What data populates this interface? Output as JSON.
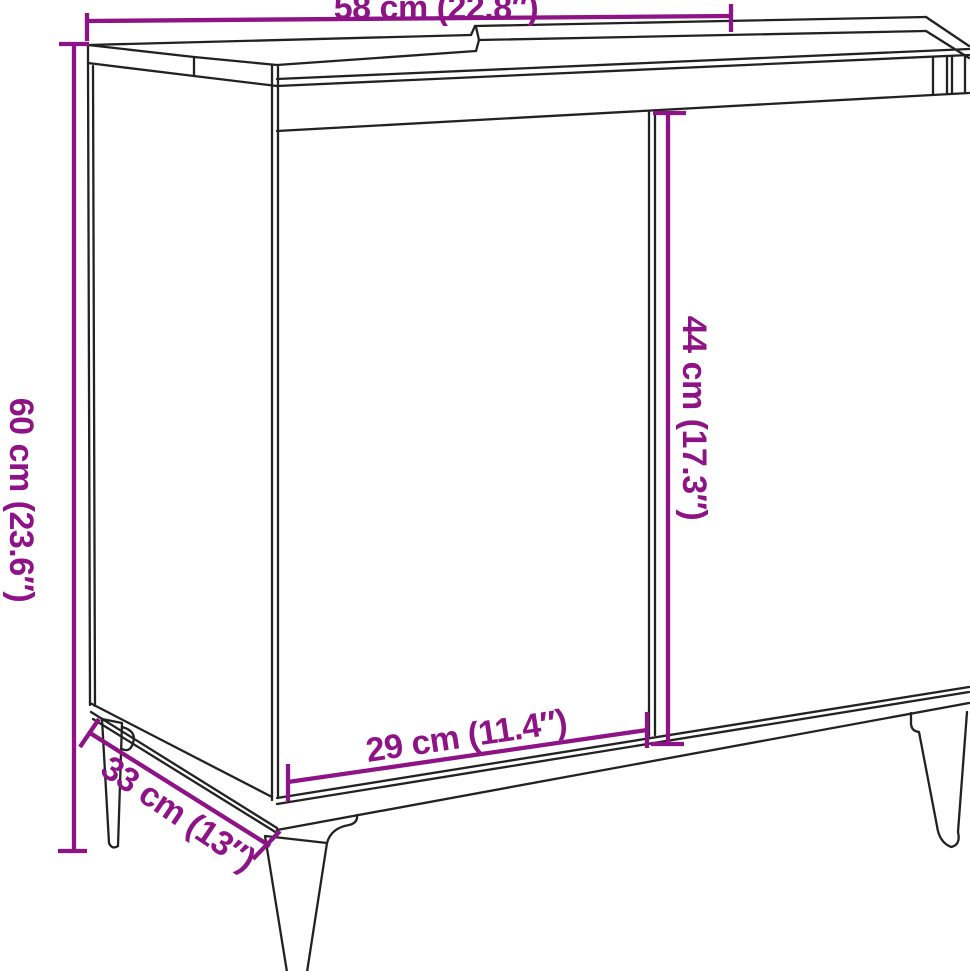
{
  "diagram": {
    "background_color": "#ffffff",
    "accent_color": "#8E1386",
    "line_color": "#222222",
    "dimensions": {
      "top_width": "58 cm (22.8″)",
      "total_height": "60 cm (23.6″)",
      "door_height": "44 cm (17.3″)",
      "door_width": "29 cm (11.4″)",
      "depth": "33 cm (13″)"
    }
  }
}
